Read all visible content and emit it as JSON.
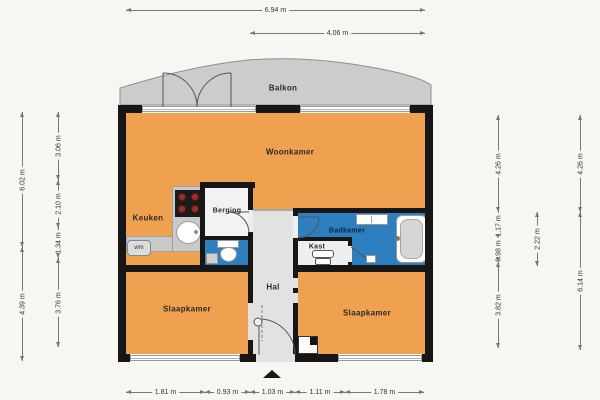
{
  "floorplan": {
    "rooms": {
      "balkon": "Balkon",
      "woonkamer": "Woonkamer",
      "keuken": "Keuken",
      "berging": "Berging",
      "badkamer": "Badkamer",
      "kast": "Kast",
      "hal": "Hal",
      "slaapkamer_left": "Slaapkamer",
      "slaapkamer_right": "Slaapkamer"
    },
    "appliances": {
      "washing_machine": "wm"
    },
    "colors": {
      "room_fill": "#f0a14f",
      "wet_room_fill": "#2e7fc0",
      "hall_fill": "#e2e2e2",
      "storage_fill": "#f2f2f2",
      "balcony_fill": "#cccccc",
      "wall": "#161616",
      "background": "#f7f6f3"
    },
    "dimensions": {
      "top": [
        "6.94 m",
        "4.06 m"
      ],
      "left_outer": [
        "6.02 m",
        "4.39 m"
      ],
      "left_inner": [
        "3.06 m",
        "2.10 m",
        "1.34 m",
        "3.76 m"
      ],
      "right_inner": [
        "4.26 m",
        "1.17 m",
        "0.98 m",
        "3.82 m"
      ],
      "right_middle": [
        "2.22 m"
      ],
      "right_outer": [
        "4.26 m",
        "6.14 m"
      ],
      "bottom": [
        "1.81 m",
        "0.93 m",
        "1.03 m",
        "1.11 m",
        "1.78 m"
      ]
    }
  }
}
